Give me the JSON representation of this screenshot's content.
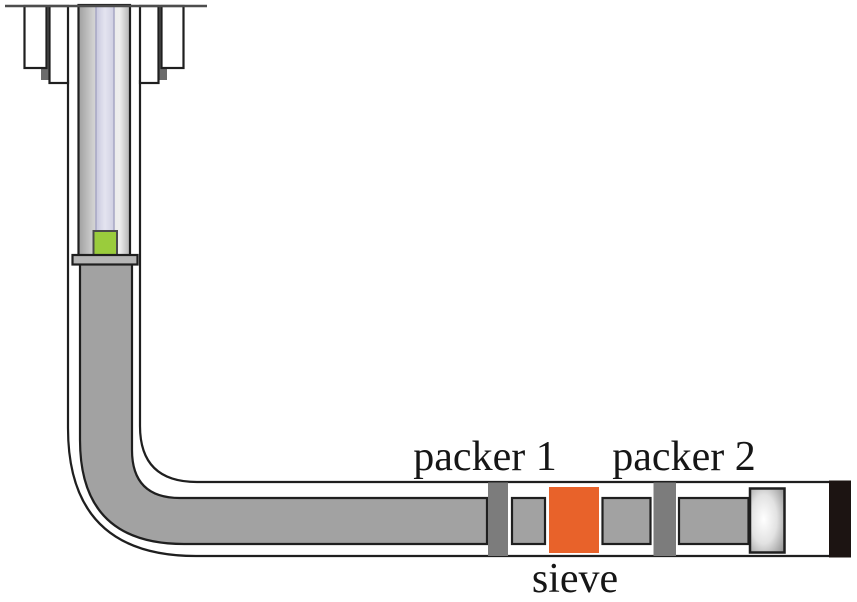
{
  "figure": {
    "type": "well-completion-schematic",
    "labels": {
      "packer1": "packer 1",
      "packer2": "packer 2",
      "sieve": "sieve"
    },
    "colors": {
      "tubing_gray": "#a2a2a2",
      "packer_gray": "#7c7c7c",
      "sieve_orange": "#e8622a",
      "plug_green": "#9acc3c",
      "inner_string_lavender": "#dcdcea",
      "flange_gray": "#b6b6b6",
      "wellhead_bar_gray": "#6b6b6b",
      "end_cap_black": "#1c1412",
      "outline_black": "#1f1f1f",
      "background": "#ffffff"
    }
  }
}
